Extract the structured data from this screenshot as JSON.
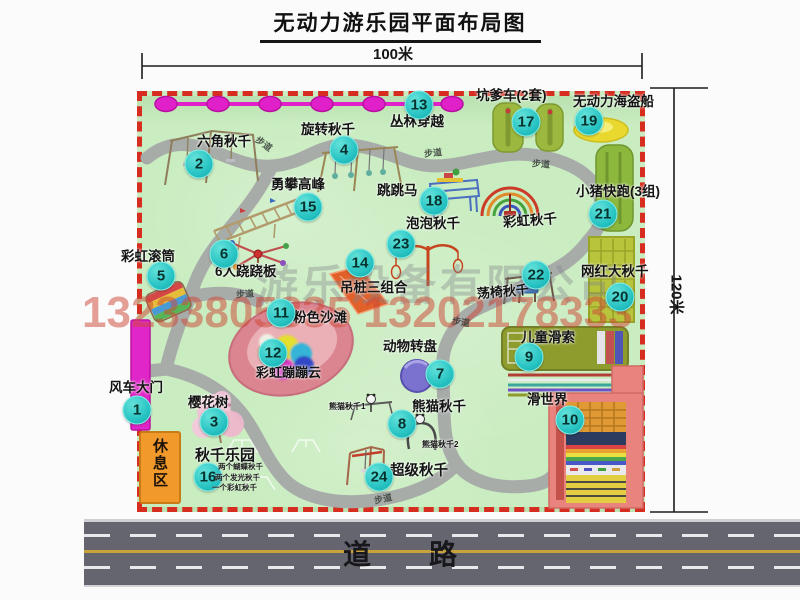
{
  "page": {
    "title": "无动力游乐园平面布局图"
  },
  "dimensions": {
    "horizontal": "100米",
    "vertical": "120米"
  },
  "map": {
    "attractions": [
      {
        "num": "1",
        "name": "风车大门"
      },
      {
        "num": "2",
        "name": "六角秋千"
      },
      {
        "num": "3",
        "name": "樱花树"
      },
      {
        "num": "4",
        "name": "旋转秋千"
      },
      {
        "num": "5",
        "name": "彩虹滚筒"
      },
      {
        "num": "6",
        "name": "6人跷跷板"
      },
      {
        "num": "7",
        "name": "动物转盘"
      },
      {
        "num": "8",
        "name": "熊猫秋千"
      },
      {
        "num": "9",
        "name": "儿童滑索"
      },
      {
        "num": "10",
        "name": "滑世界"
      },
      {
        "num": "11",
        "name": "粉色沙滩"
      },
      {
        "num": "12",
        "name": "彩虹蹦蹦云"
      },
      {
        "num": "13",
        "name": "丛林穿越"
      },
      {
        "num": "14",
        "name": "吊桩三组合"
      },
      {
        "num": "15",
        "name": "勇攀高峰"
      },
      {
        "num": "16",
        "name": "秋千乐园"
      },
      {
        "num": "17",
        "name": "坑爹车(2套)"
      },
      {
        "num": "18",
        "name": "跳跳马"
      },
      {
        "num": "19",
        "name": "无动力海盗船"
      },
      {
        "num": "20",
        "name": "网红大秋千"
      },
      {
        "num": "21",
        "name": "小猪快跑(3组)"
      },
      {
        "num": "22",
        "name": "荡椅秋千"
      },
      {
        "num": "23",
        "name": "泡泡秋千"
      },
      {
        "num": "24",
        "name": "超级秋千"
      }
    ],
    "unnumbered_labels": [
      "彩虹秋千",
      "熊猫秋千1",
      "熊猫秋千2"
    ],
    "swing_park_notes": [
      "两个蝴蝶秋千",
      "两个发光秋千",
      "一个彩虹秋千"
    ],
    "rest_area_label": "休息区",
    "path_label": "步道"
  },
  "watermark": {
    "company": "游乐设备有限公司",
    "phone": "13233805835 13202178333"
  },
  "road": {
    "label": "道路"
  },
  "colors": {
    "map_green": "#c9ecc0",
    "border_red": "#d62d20",
    "badge_teal": "#25c2c2",
    "zipline_magenta": "#e020c8",
    "gate_magenta": "#e126c9",
    "rest_area_orange": "#f19a2b",
    "road_gray": "#656570"
  }
}
